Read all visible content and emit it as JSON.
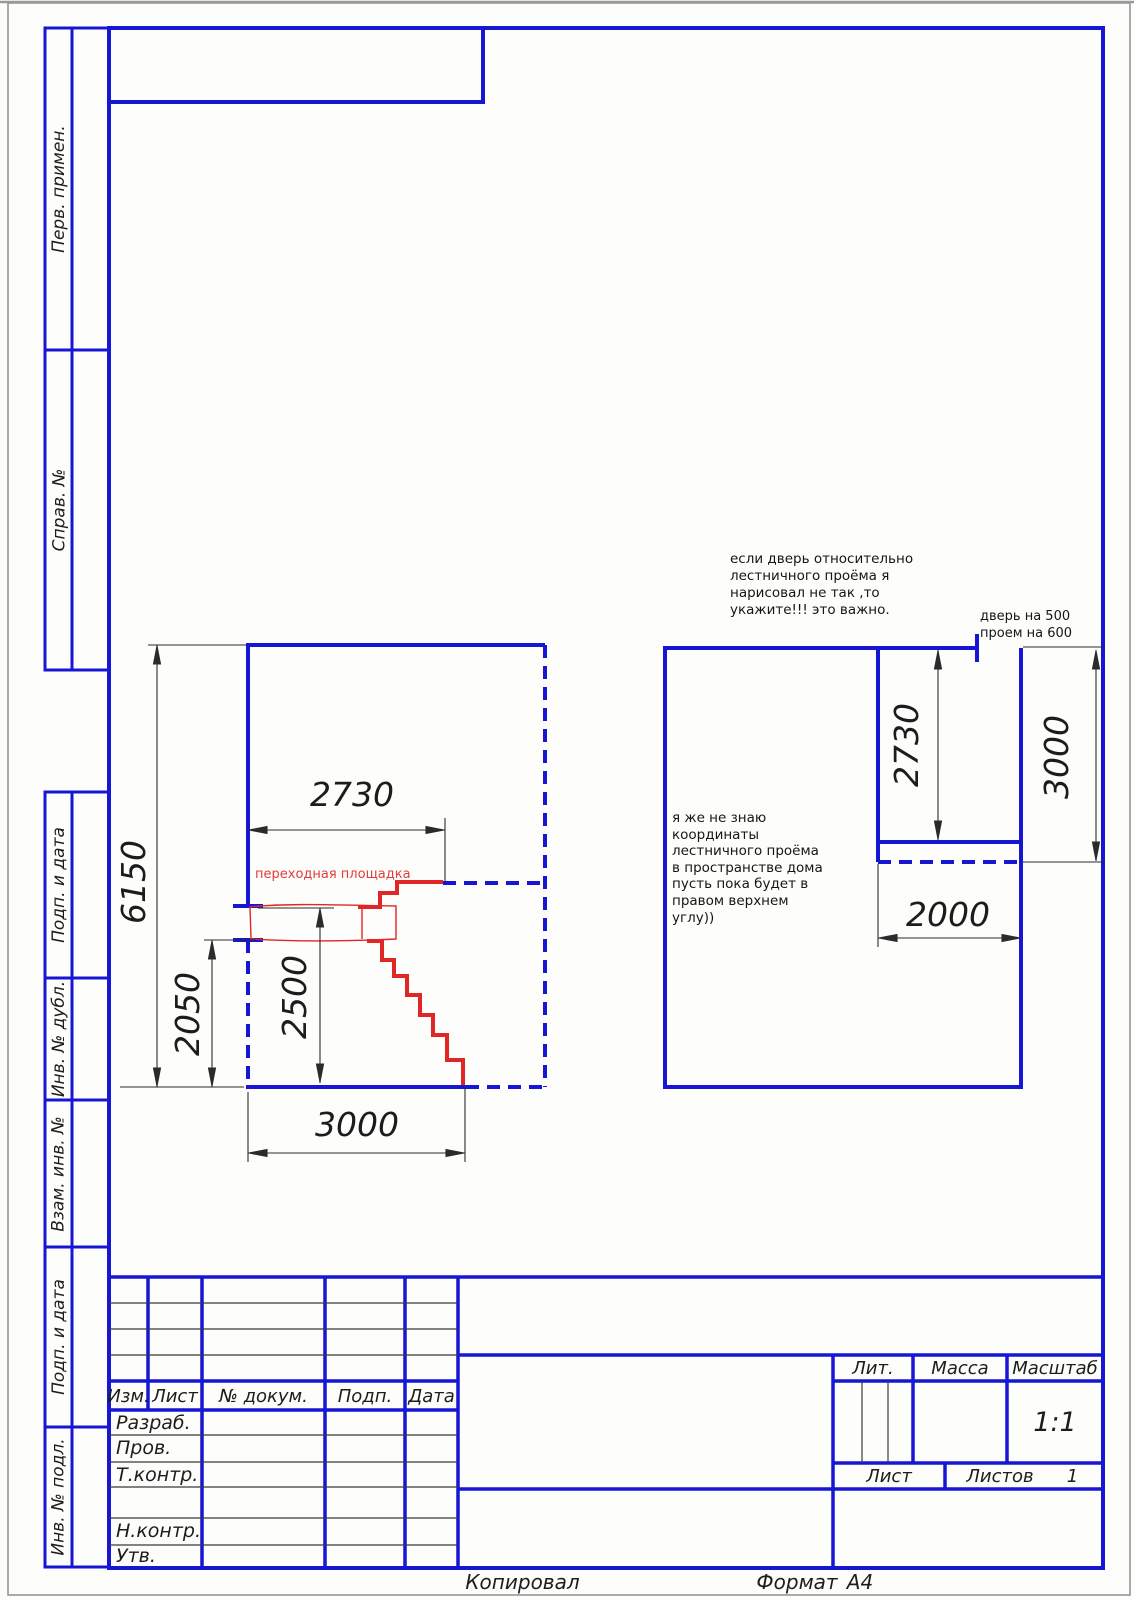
{
  "sheet": {
    "copied_label": "Копировал",
    "format_label": "Формат",
    "format_value": "А4"
  },
  "margin_boxes": [
    {
      "label": "Перв. примен."
    },
    {
      "label": "Справ. №"
    },
    {
      "label": "Подп. и дата"
    },
    {
      "label": "Инв. № дубл."
    },
    {
      "label": "Взам. инв. №"
    },
    {
      "label": "Подп. и дата"
    },
    {
      "label": "Инв. № подл."
    }
  ],
  "title_block": {
    "revision_headers": [
      "Изм.",
      "Лист",
      "№ докум.",
      "Подп.",
      "Дата"
    ],
    "signature_rows": [
      "Разраб.",
      "Пров.",
      "Т.контр.",
      "",
      "Н.контр.",
      "Утв."
    ],
    "lit_label": "Лит.",
    "mass_label": "Масса",
    "scale_label": "Масштаб",
    "scale_value": "1:1",
    "sheet_label": "Лист",
    "sheets_label": "Листов",
    "sheets_value": "1"
  },
  "drawing": {
    "left_plan": {
      "landing_label": "переходная площадка",
      "dim_height": "6150",
      "dim_opening_width": "2730",
      "dim_lower": "2050",
      "dim_stair": "2500",
      "dim_width": "3000"
    },
    "right_plan": {
      "dim_opening_height": "2730",
      "dim_right_wall": "3000",
      "dim_opening_width": "2000"
    }
  },
  "annotations": {
    "door_note_lines": [
      "если дверь относительно",
      "лестничного проёма я",
      "нарисовал не так ,то",
      "укажите!!! это важно."
    ],
    "door_size_lines": [
      "дверь на 500",
      "проем на 600"
    ],
    "coords_note_lines": [
      "я же не знаю",
      "координаты",
      "лестничного проёма",
      "в пространстве дома",
      "пусть пока будет в",
      "правом верхнем",
      "углу))"
    ]
  },
  "colors": {
    "line_blue": "#1616d4",
    "stair_red": "#e12626",
    "annotation_red": "#e03c3c",
    "text_black": "#1d1d1d"
  }
}
